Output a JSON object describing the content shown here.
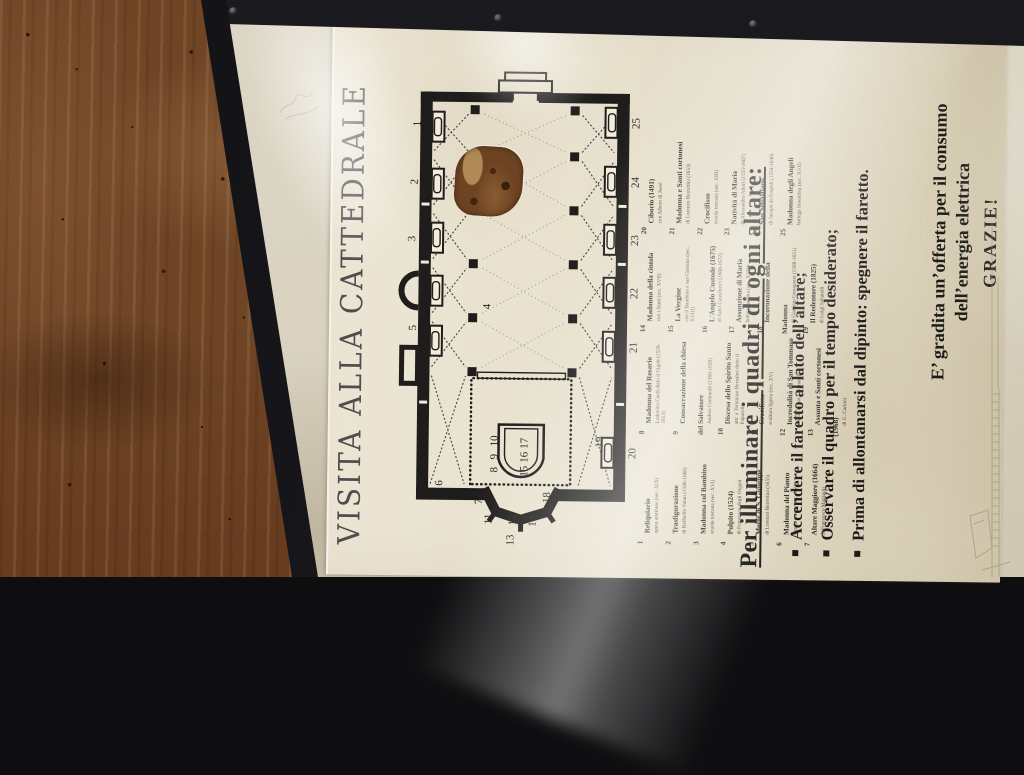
{
  "sign": {
    "title": "Visita alla Cattedrale",
    "plan": {
      "numbers": [
        {
          "n": "1",
          "x": 449,
          "y": 78
        },
        {
          "n": "2",
          "x": 391,
          "y": 76
        },
        {
          "n": "3",
          "x": 334,
          "y": 74
        },
        {
          "n": "4",
          "x": 267,
          "y": 150
        },
        {
          "n": "5",
          "x": 245,
          "y": 76
        },
        {
          "n": "6",
          "x": 90,
          "y": 104
        },
        {
          "n": "7",
          "x": 72,
          "y": 144
        },
        {
          "n": "8",
          "x": 104,
          "y": 159
        },
        {
          "n": "9",
          "x": 117,
          "y": 159
        },
        {
          "n": "10",
          "x": 130,
          "y": 159
        },
        {
          "n": "11",
          "x": 52,
          "y": 154
        },
        {
          "n": "12",
          "x": 51,
          "y": 178
        },
        {
          "n": "13",
          "x": 31,
          "y": 176
        },
        {
          "n": "14",
          "x": 50,
          "y": 198
        },
        {
          "n": "15",
          "x": 100,
          "y": 189
        },
        {
          "n": "16",
          "x": 114,
          "y": 189
        },
        {
          "n": "17",
          "x": 128,
          "y": 189
        },
        {
          "n": "18",
          "x": 74,
          "y": 212
        },
        {
          "n": "19",
          "x": 130,
          "y": 264
        },
        {
          "n": "20",
          "x": 119,
          "y": 297
        },
        {
          "n": "21",
          "x": 225,
          "y": 297
        },
        {
          "n": "22",
          "x": 279,
          "y": 297
        },
        {
          "n": "23",
          "x": 332,
          "y": 297
        },
        {
          "n": "24",
          "x": 390,
          "y": 297
        },
        {
          "n": "25",
          "x": 449,
          "y": 297
        }
      ]
    },
    "legend": {
      "columns": [
        {
          "items": [
            {
              "n": "1",
              "title": "Reliquiario",
              "detail": "opera aretinese (sec. XIX)"
            },
            {
              "n": "2",
              "title": "Trasfigurazione",
              "detail": "di Raffaello Vanni (1596-1660)"
            },
            {
              "n": "3",
              "title": "Madonna col Bambino",
              "detail": "scuola toscana (sec. XVI)"
            },
            {
              "n": "4",
              "title": "Pulpito (1524)",
              "detail": "di Francesco degli Organi"
            },
            {
              "n": "5",
              "title": "Morte di S. Giuseppe",
              "detail": "di Lorenzo Berrettini (1655)"
            },
            {
              "n": "6",
              "title": "Madonna del Pianto",
              "detail": "scuola senese (sec. XV)"
            },
            {
              "n": "7",
              "title": "Altare Maggiore (1664)",
              "detail": "di Francesco Mazzuoli"
            }
          ]
        },
        {
          "items": [
            {
              "n": "8",
              "title": "Madonna del Rosario",
              "detail": "Lodovico Cardi detto il Cigoli (1559-1613)"
            },
            {
              "n": "9",
              "title": "Consacrazione della chiesa del Salvatore",
              "detail": "Andrea Commodi (1560-1638)"
            },
            {
              "n": "10",
              "title": "Discesa dello Spirito Santo",
              "detail": "attr. a Tommaso Bernabei detto il Papacello"
            },
            {
              "n": "11",
              "title": "Crocifisso",
              "detail": "scultura lignea (sec. XV)"
            },
            {
              "n": "12",
              "title": "Incredulità di San Tommaso",
              "detail": "scuola di Luca Signorelli"
            },
            {
              "n": "13",
              "title": "Assunta e Santi cortonesi (1968)",
              "detail": "di G. Carloni"
            }
          ]
        },
        {
          "items": [
            {
              "n": "14",
              "title": "Madonna della cintola",
              "detail": "con i Santi (sec. XVII)"
            },
            {
              "n": "15",
              "title": "La Vergine",
              "detail": "con il Bambino e san Gaetano (sec. XVIII)"
            },
            {
              "n": "16",
              "title": "L'Angelo Custode (1675)",
              "detail": "di Salvi Castellucci (1608-1672)"
            },
            {
              "n": "17",
              "title": "Assunzione di Maria",
              "detail": "bottega aretina (sec. XVII)"
            },
            {
              "n": "18",
              "title": "Incoronazione della Madonna",
              "detail": "di Giacinto Gimignani (1588-1651)"
            },
            {
              "n": "19",
              "title": "Il Redentore (1825)",
              "detail": "di Luigi Sabatelli"
            }
          ]
        },
        {
          "items": [
            {
              "n": "20",
              "title": "Ciborio (1491)",
              "detail": "con Albero di Jessé"
            },
            {
              "n": "21",
              "title": "Madonna e Santi cortonesi",
              "detail": "di Lorenzo Berrettini (1653)"
            },
            {
              "n": "22",
              "title": "Crocifisso",
              "detail": "scuola toscana (sec. XIII)"
            },
            {
              "n": "23",
              "title": "Natività di Maria",
              "detail": "di Alessandro Allori (1535-1607)"
            },
            {
              "n": "24",
              "title": "San Sebastiano",
              "detail": "di Jacopo da Empoli (1554-1640)"
            },
            {
              "n": "25",
              "title": "Madonna degli Angeli",
              "detail": "bottega fiorentina (sec. XVII)"
            }
          ]
        }
      ]
    },
    "instructions": {
      "heading": "Per illuminare i quadri di ogni altare:",
      "bullets": [
        "Accendere il faretto al lato dell’altare;",
        "Osservare il quadro per il tempo desiderato;",
        "Prima di allontanarsi dal dipinto: spegnere il faretto."
      ]
    },
    "offer": {
      "line1": "E’ gradita un’offerta per il consumo",
      "line2": "dell’energia elettrica",
      "line3": "GRAZIE!"
    }
  },
  "scene": {
    "colors": {
      "wood": "#6f4526",
      "frame": "#17171a",
      "backing": "#d9d2c0",
      "paper": "#e7e0cd",
      "ink": "#1d1b17",
      "damage_patch": "#6d4322"
    }
  }
}
